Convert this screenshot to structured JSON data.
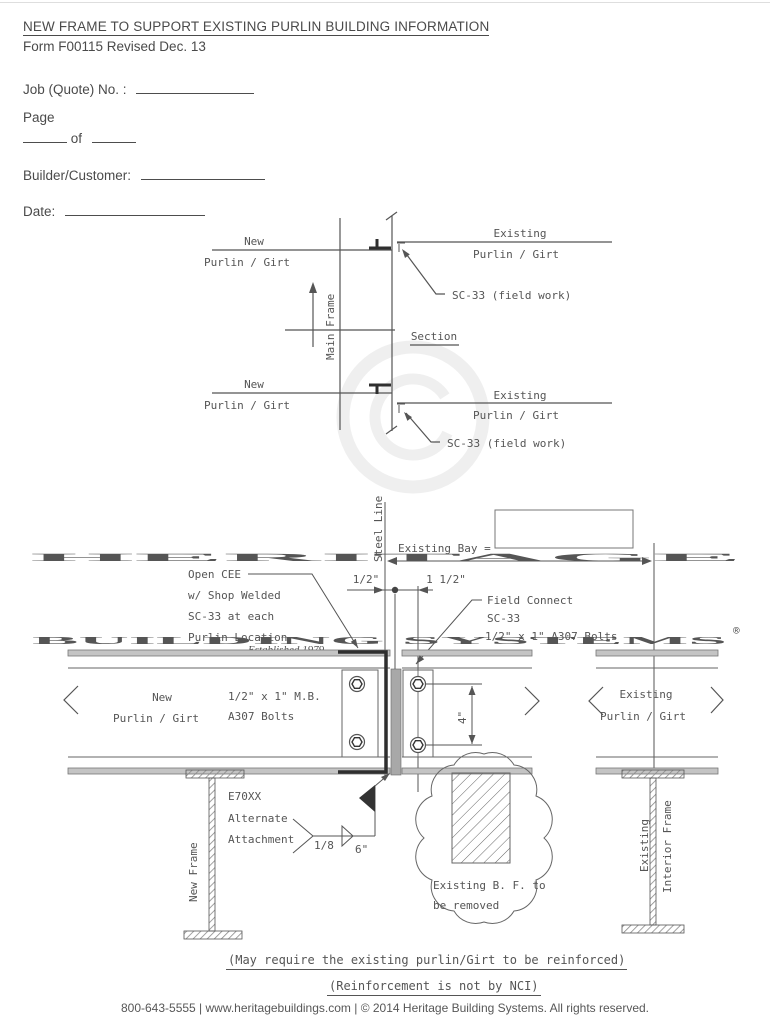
{
  "header": {
    "title": "NEW FRAME TO SUPPORT EXISTING PURLIN BUILDING INFORMATION",
    "form_info": "Form F00115 Revised Dec. 13",
    "job_label": "Job (Quote) No. :",
    "page_label": "Page",
    "of_label": "of",
    "builder_label": "Builder/Customer:",
    "date_label": "Date:"
  },
  "watermark": {
    "brand_line1": "HERITAGE",
    "brand_line2": "BUILDING SYSTEMS",
    "registered": "®",
    "tagline": "Established 1979"
  },
  "section_view": {
    "new_label": "New",
    "purlin_girt": "Purlin / Girt",
    "existing_label": "Existing",
    "sc33_note": "SC-33 (field work)",
    "main_frame": "Main Frame",
    "section_title": "Section"
  },
  "detail_view": {
    "steel_line": "Steel Line",
    "existing_bay": "Existing Bay =",
    "dim_half_inch": "1/2\"",
    "dim_one_half_inch": "1 1/2\"",
    "dim_four_inch": "4\"",
    "open_cee_note": [
      "Open CEE",
      "w/ Shop Welded",
      "SC-33 at each",
      "Purlin Location"
    ],
    "field_connect_note": [
      "Field Connect",
      "SC-33",
      "1/2\" x 1\" A307 Bolts"
    ],
    "new_label": "New",
    "purlin_girt": "Purlin / Girt",
    "mb_bolts_note": [
      "1/2\" x 1\" M.B.",
      "A307 Bolts"
    ],
    "existing_label": "Existing",
    "new_frame": "New Frame",
    "weld_note": [
      "E70XX",
      "Alternate",
      "Attachment"
    ],
    "weld_size": "1/8",
    "weld_length": "6\"",
    "bf_note": [
      "Existing B. F. to",
      "be removed"
    ],
    "existing_interior": [
      "Existing",
      "Interior Frame"
    ]
  },
  "notes": {
    "line1": "(May require the existing purlin/Girt to be reinforced)",
    "line2": "(Reinforcement is not by NCI)"
  },
  "footer": {
    "text": "800-643-5555   |   www.heritagebuildings.com   |   © 2014 Heritage Building Systems. All rights reserved."
  }
}
